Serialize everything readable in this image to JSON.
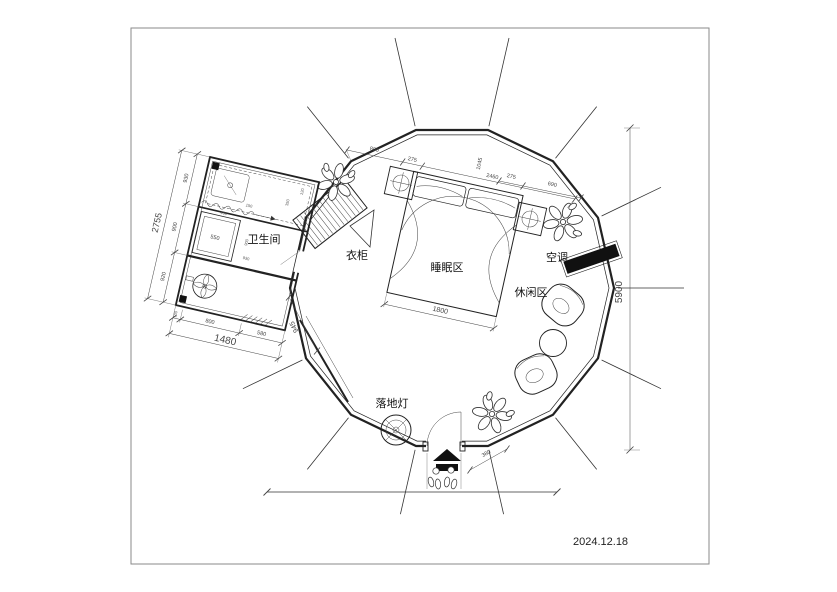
{
  "frame": {
    "date": "2024.12.18"
  },
  "labels": {
    "bathroom": "卫生间",
    "wardrobe": "衣柜",
    "sleeping_area": "睡眠区",
    "leisure_area": "休闲区",
    "air_conditioner": "空调",
    "floor_lamp": "落地灯"
  },
  "dimensions": {
    "top_chain": {
      "seg_800": "800",
      "seg_275": "275",
      "seg_2460": "2460",
      "seg_1045": "1045"
    },
    "top_chain_right": {
      "seg_275": "275",
      "seg_690": "690"
    },
    "overall_height": "5900",
    "bed_width": "1800",
    "entrance_offset": "380",
    "bathroom": {
      "left_total": "2755",
      "left_seg_1": "930",
      "left_seg_2": "900",
      "left_seg_3": "920",
      "bottom_total": "1480",
      "bottom_seg_1": "100",
      "bottom_seg_2": "800",
      "bottom_seg_3": "580",
      "passage": "945",
      "washer": "550",
      "inner_900": "900",
      "inner_930": "930",
      "tiny_400": "400",
      "tiny_350": "350",
      "tiny_120": "120",
      "tiny_150": "150"
    }
  },
  "colors": {
    "wall": "#222222",
    "fill_black": "#111111",
    "dim_text": "#444444"
  }
}
